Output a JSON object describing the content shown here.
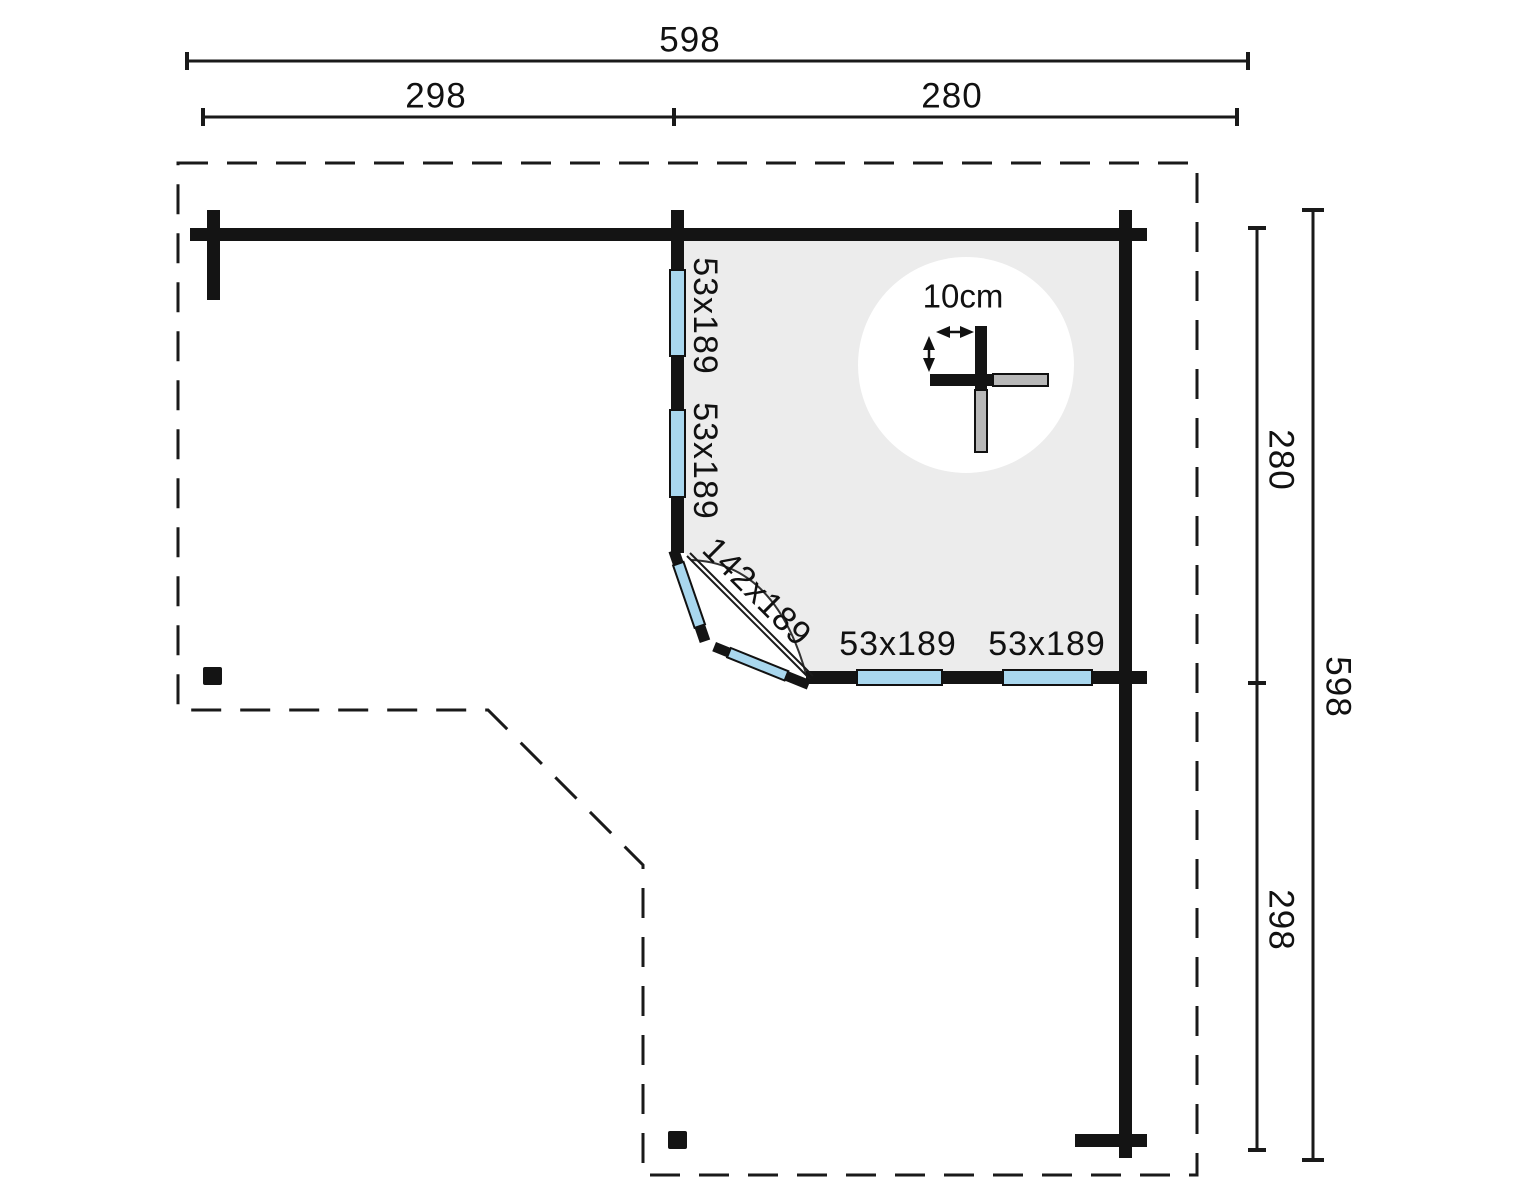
{
  "dimensions": {
    "top_total": "598",
    "top_left_section": "298",
    "top_right_section": "280",
    "right_top_section": "280",
    "right_total": "598",
    "right_bottom_section": "298"
  },
  "plan": {
    "left_wall_windows": [
      {
        "size": "53x189"
      },
      {
        "size": "53x189"
      }
    ],
    "corner_door": {
      "size": "142x189"
    },
    "bottom_wall_windows": [
      {
        "size": "53x189"
      },
      {
        "size": "53x189"
      }
    ]
  },
  "detail": {
    "log_spacing": "10cm"
  },
  "colors": {
    "wall": "#141414",
    "window_fill": "#a9d7ee",
    "room_fill": "#ececec",
    "detail_log_fill": "#b8b8b8",
    "line": "#1a1a1a",
    "background": "#ffffff"
  }
}
